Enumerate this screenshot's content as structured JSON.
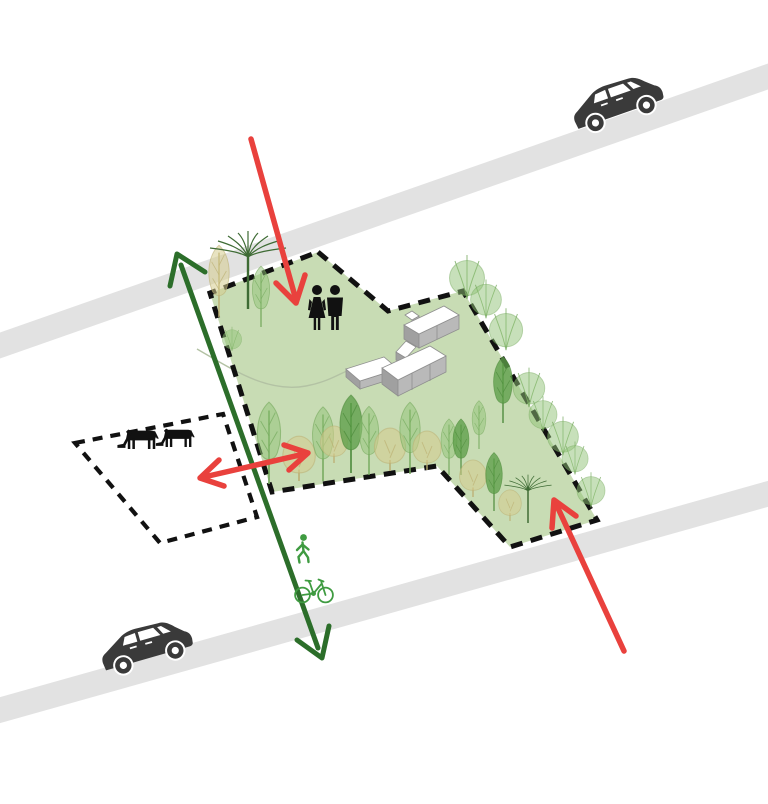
{
  "diagram": {
    "kind": "site-concept-diagram",
    "description_labels": {
      "site": "green site parcel with dashed boundary",
      "paddock": "adjacent paddock parcel with dashed boundary",
      "buildings": "farmstead building cluster",
      "road_top": "upper road",
      "road_bottom": "lower road",
      "green_route": "slow route through site (two-way)",
      "red_access_top": "access from upper road",
      "red_access_side": "two-way link to paddock",
      "red_access_bottom": "access from lower road",
      "people": "pedestrians on site",
      "horses": "grazing horses",
      "slow_traffic": "pedestrian and bicycle traffic"
    },
    "icon_names": [
      "car-icon",
      "car-icon",
      "horse-icon",
      "horse-icon",
      "woman-icon",
      "man-icon",
      "pedestrian-icon",
      "bicycle-icon",
      "tree-icon",
      "shrub-icon",
      "fan-tree-icon",
      "arrow-down-icon",
      "arrow-double-icon",
      "arrow-up-icon",
      "arrow-two-way-icon"
    ],
    "counts": {
      "cars": 2,
      "horses": 2,
      "people": 2,
      "buildings": 2,
      "red_arrows": 3,
      "green_arrows": 1
    }
  },
  "colors": {
    "background": "#ffffff",
    "road": "#e2e2e2",
    "car": "#3a3a3a",
    "site_fill": "#c8dcb4",
    "boundary_dash": "#111111",
    "path_line": "#b3c2a4",
    "building_top": "#ffffff",
    "building_side": "#b9b9b9",
    "building_side_dark": "#a0a0a0",
    "building_stroke": "#8f8f8f",
    "tree_light": "#8fc276",
    "tree_light_stroke": "#74a95c",
    "tree_medium": "#5d9f49",
    "tree_medium_stroke": "#4c8a3b",
    "tree_beige": "#d6cc8e",
    "tree_beige_stroke": "#bcb074",
    "tree_dark_line": "#3e6b34",
    "arrow_red": "#e9413d",
    "arrow_green": "#2c6e2a",
    "icon_green": "#3f9b41",
    "icon_black": "#111111"
  }
}
